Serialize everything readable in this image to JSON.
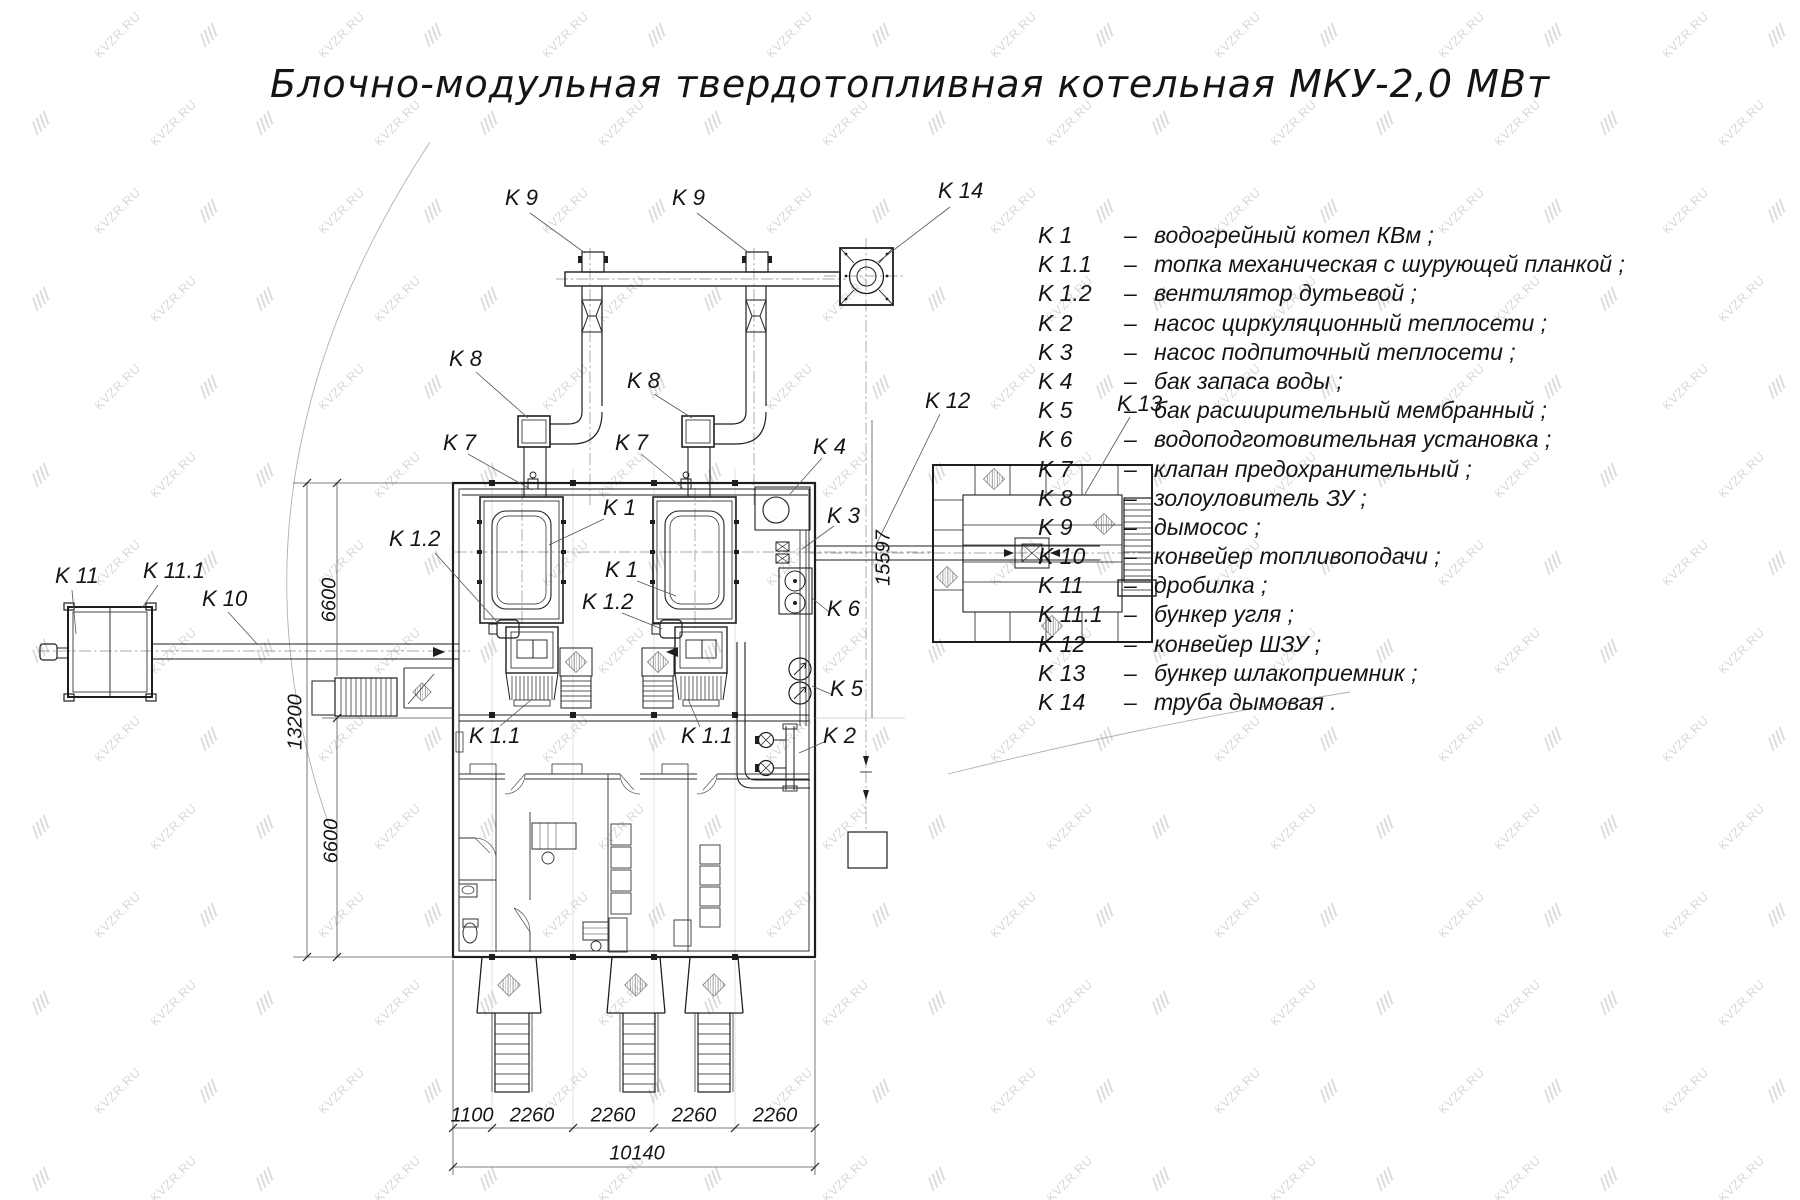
{
  "title": "Блочно-модульная твердотопливная котельная МКУ-2,0 МВт",
  "watermark": {
    "text": "KVZR.RU"
  },
  "colors": {
    "line": "#222222",
    "thin": "#888888",
    "watermark": "#bdbdbd"
  },
  "legend": {
    "sep": "–",
    "items": [
      {
        "code": "K 1",
        "desc": "водогрейный котел КВм ;"
      },
      {
        "code": "K 1.1",
        "desc": "топка механическая с шурующей планкой ;"
      },
      {
        "code": "K 1.2",
        "desc": "вентилятор дутьевой ;"
      },
      {
        "code": "K 2",
        "desc": "насос циркуляционный теплосети ;"
      },
      {
        "code": "K 3",
        "desc": "насос подпиточный теплосети ;"
      },
      {
        "code": "K 4",
        "desc": "бак запаса воды ;"
      },
      {
        "code": "K 5",
        "desc": "бак расширительный мембранный ;"
      },
      {
        "code": "K 6",
        "desc": "водоподготовительная установка ;"
      },
      {
        "code": "K 7",
        "desc": "клапан предохранительный ;"
      },
      {
        "code": "K 8",
        "desc": "золоуловитель ЗУ ;"
      },
      {
        "code": "K 9",
        "desc": "дымосос ;"
      },
      {
        "code": "K 10",
        "desc": "конвейер топливоподачи ;"
      },
      {
        "code": "K 11",
        "desc": "дробилка ;"
      },
      {
        "code": "K 11.1",
        "desc": "бункер угля ;"
      },
      {
        "code": "K 12",
        "desc": "конвейер ШЗУ ;"
      },
      {
        "code": "K 13",
        "desc": "бункер шлакоприемник ;"
      },
      {
        "code": "K 14",
        "desc": "труба дымовая ."
      }
    ]
  },
  "drawing": {
    "labels": [
      {
        "id": "k9-left",
        "text": "K 9",
        "x": 505,
        "y": 185
      },
      {
        "id": "k9-right",
        "text": "K 9",
        "x": 672,
        "y": 185
      },
      {
        "id": "k14",
        "text": "K 14",
        "x": 938,
        "y": 178
      },
      {
        "id": "k8-left",
        "text": "K 8",
        "x": 449,
        "y": 346
      },
      {
        "id": "k8-right",
        "text": "K 8",
        "x": 627,
        "y": 368
      },
      {
        "id": "k7-left",
        "text": "K 7",
        "x": 443,
        "y": 430
      },
      {
        "id": "k7-right",
        "text": "K 7",
        "x": 615,
        "y": 430
      },
      {
        "id": "k4",
        "text": "K 4",
        "x": 813,
        "y": 434
      },
      {
        "id": "k3",
        "text": "K 3",
        "x": 827,
        "y": 503
      },
      {
        "id": "k12",
        "text": "K 12",
        "x": 925,
        "y": 388
      },
      {
        "id": "k13",
        "text": "K 13",
        "x": 1117,
        "y": 391
      },
      {
        "id": "k1-upper",
        "text": "K 1",
        "x": 603,
        "y": 495
      },
      {
        "id": "k1-lower",
        "text": "K 1",
        "x": 605,
        "y": 557
      },
      {
        "id": "k1-2-left",
        "text": "K 1.2",
        "x": 389,
        "y": 526
      },
      {
        "id": "k1-2-center",
        "text": "K 1.2",
        "x": 582,
        "y": 589
      },
      {
        "id": "k6",
        "text": "K 6",
        "x": 827,
        "y": 596
      },
      {
        "id": "k5",
        "text": "K 5",
        "x": 830,
        "y": 676
      },
      {
        "id": "k2",
        "text": "K 2",
        "x": 823,
        "y": 723
      },
      {
        "id": "k11",
        "text": "K 11",
        "x": 55,
        "y": 563
      },
      {
        "id": "k11-1",
        "text": "K 11.1",
        "x": 143,
        "y": 558
      },
      {
        "id": "k10",
        "text": "K 10",
        "x": 202,
        "y": 586
      },
      {
        "id": "k1-1-left",
        "text": "K 1.1",
        "x": 469,
        "y": 723
      },
      {
        "id": "k1-1-right",
        "text": "K 1.1",
        "x": 681,
        "y": 723
      }
    ],
    "dimensions": [
      {
        "id": "dim-6600-top",
        "text": "6600",
        "x": 330,
        "y": 600,
        "rot": -90
      },
      {
        "id": "dim-13200",
        "text": "13200",
        "x": 296,
        "y": 722,
        "rot": -90
      },
      {
        "id": "dim-6600-bottom",
        "text": "6600",
        "x": 332,
        "y": 841,
        "rot": -90
      },
      {
        "id": "dim-15597",
        "text": "15597",
        "x": 884,
        "y": 558,
        "rot": -90
      },
      {
        "id": "dim-1100",
        "text": "1100",
        "x": 472,
        "y": 1116
      },
      {
        "id": "dim-2260-1",
        "text": "2260",
        "x": 532,
        "y": 1116
      },
      {
        "id": "dim-2260-2",
        "text": "2260",
        "x": 613,
        "y": 1116
      },
      {
        "id": "dim-2260-3",
        "text": "2260",
        "x": 694,
        "y": 1116
      },
      {
        "id": "dim-2260-4",
        "text": "2260",
        "x": 775,
        "y": 1116
      },
      {
        "id": "dim-10140",
        "text": "10140",
        "x": 637,
        "y": 1154
      }
    ]
  }
}
